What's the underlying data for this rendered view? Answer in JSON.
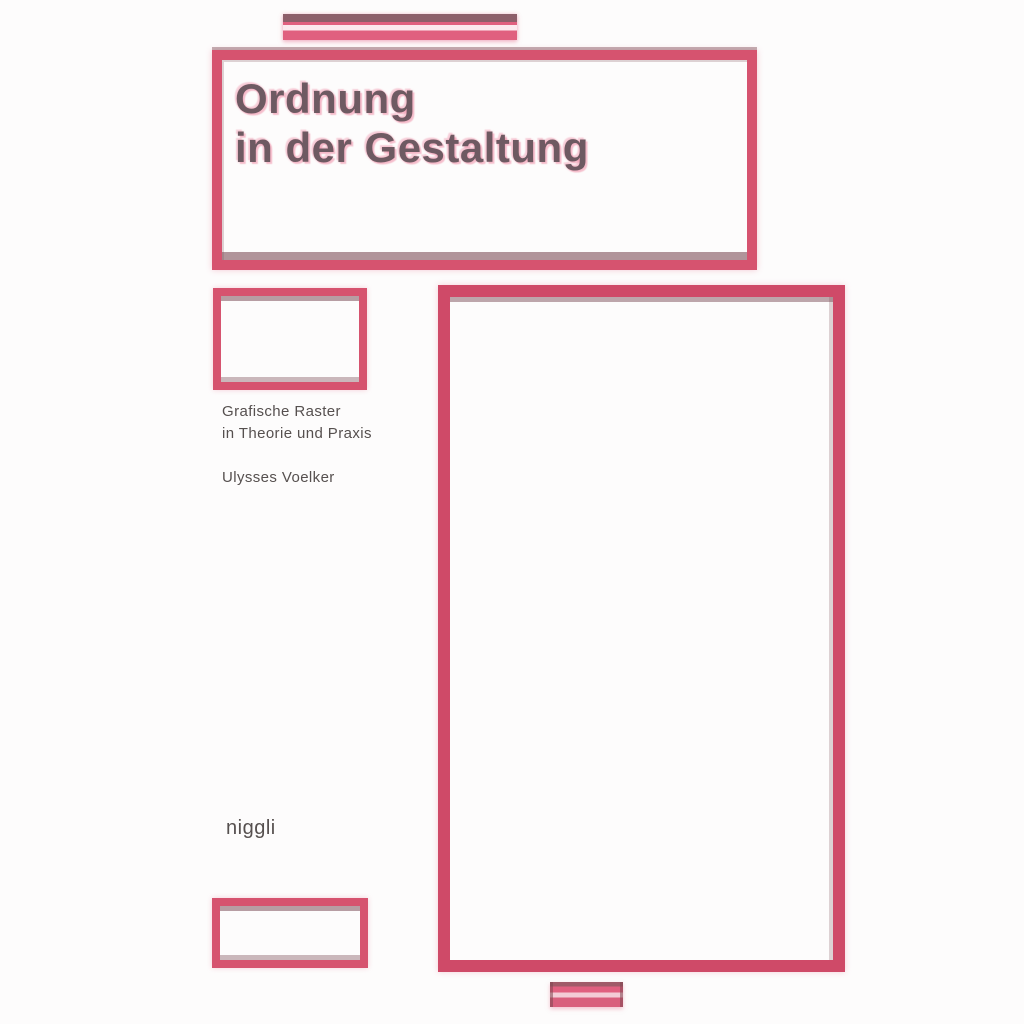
{
  "cover": {
    "title": {
      "line1": "Ordnung",
      "line2": "in der Gestaltung"
    },
    "subtitle": {
      "line1": "Grafische Raster",
      "line2": "in Theorie und Praxis"
    },
    "author": "Ulysses Voelker",
    "publisher": "niggli"
  },
  "colors": {
    "accent_pink": "#d6536f",
    "accent_crimson": "#cf4a68",
    "shadow_maroon": "#7e4f59",
    "halo_pink": "#ef8ca6",
    "stripe_light": "#fbe9ee",
    "title_gray": "#6e5a62",
    "text_gray": "#56504f",
    "background": "#fdfcfc"
  }
}
